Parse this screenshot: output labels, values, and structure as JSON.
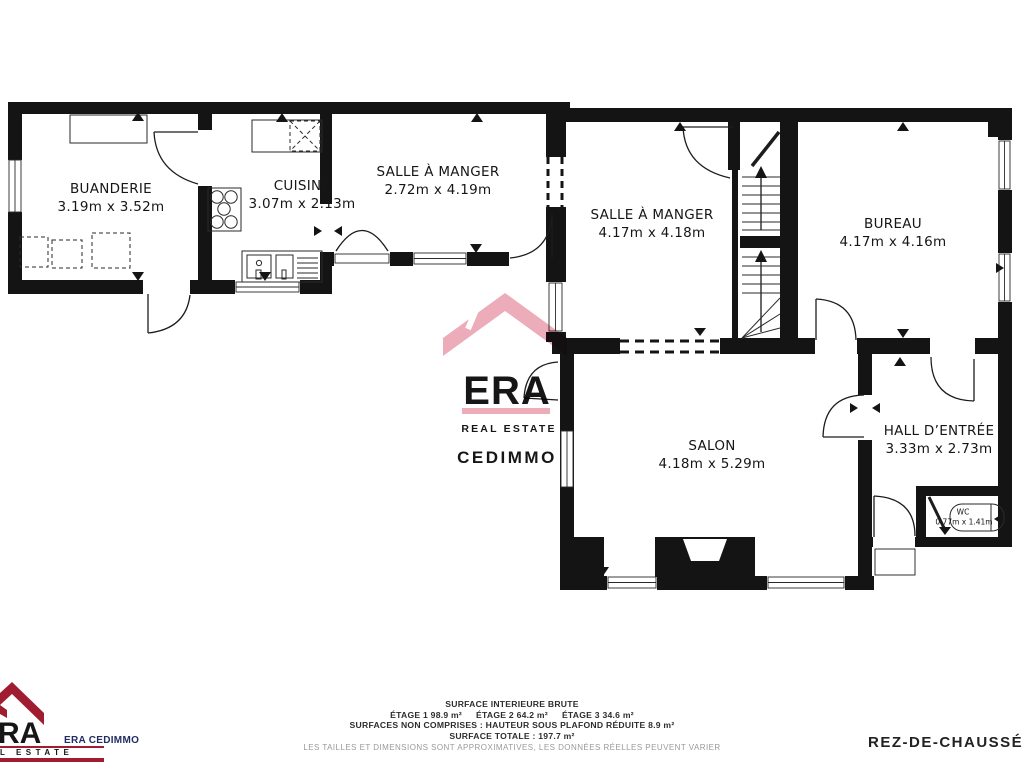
{
  "colors": {
    "wall": "#141414",
    "watermark_pink": "#ecacba",
    "watermark_lavender": "#a8a2cb",
    "logo_red": "#a01d31",
    "logo_navy": "#232c62",
    "label_dark": "#161616",
    "footer_gray": "#9a9a9a"
  },
  "rooms": [
    {
      "name": "BUANDERIE",
      "dims": "3.19m x 3.52m"
    },
    {
      "name": "CUISINE",
      "dims": "3.07m x 2.13m"
    },
    {
      "name": "SALLE À MANGER",
      "dims": "2.72m x 4.19m"
    },
    {
      "name": "SALLE À MANGER",
      "dims": "4.17m x 4.18m"
    },
    {
      "name": "BUREAU",
      "dims": "4.17m x 4.16m"
    },
    {
      "name": "SALON",
      "dims": "4.18m x 5.29m"
    },
    {
      "name": "HALL D’ENTRÉE",
      "dims": "3.33m x 2.73m"
    },
    {
      "name": "WC",
      "dims": "0.77m x 1.41m"
    }
  ],
  "watermark": {
    "era": "ERA",
    "real_estate": "REAL ESTATE",
    "cedimmo": "CEDIMMO"
  },
  "footer": {
    "logo_letters": "RA",
    "logo_estate": "L ESTATE",
    "agency": "ERA CEDIMMO",
    "surface_title": "SURFACE INTERIEURE BRUTE",
    "etage1": "ÉTAGE 1 98.9 m²",
    "etage2": "ÉTAGE 2 64.2 m²",
    "etage3": "ÉTAGE 3 34.6 m²",
    "non_comprises": "SURFACES NON COMPRISES :  HAUTEUR SOUS PLAFOND RÉDUITE 8.9 m²",
    "totale": "SURFACE TOTALE :  197.7 m²",
    "disclaimer": "LES TAILLES ET DIMENSIONS SONT APPROXIMATIVES, LES DONNÉES RÉELLES PEUVENT VARIER",
    "floor": "REZ-DE-CHAUSSÉE"
  }
}
